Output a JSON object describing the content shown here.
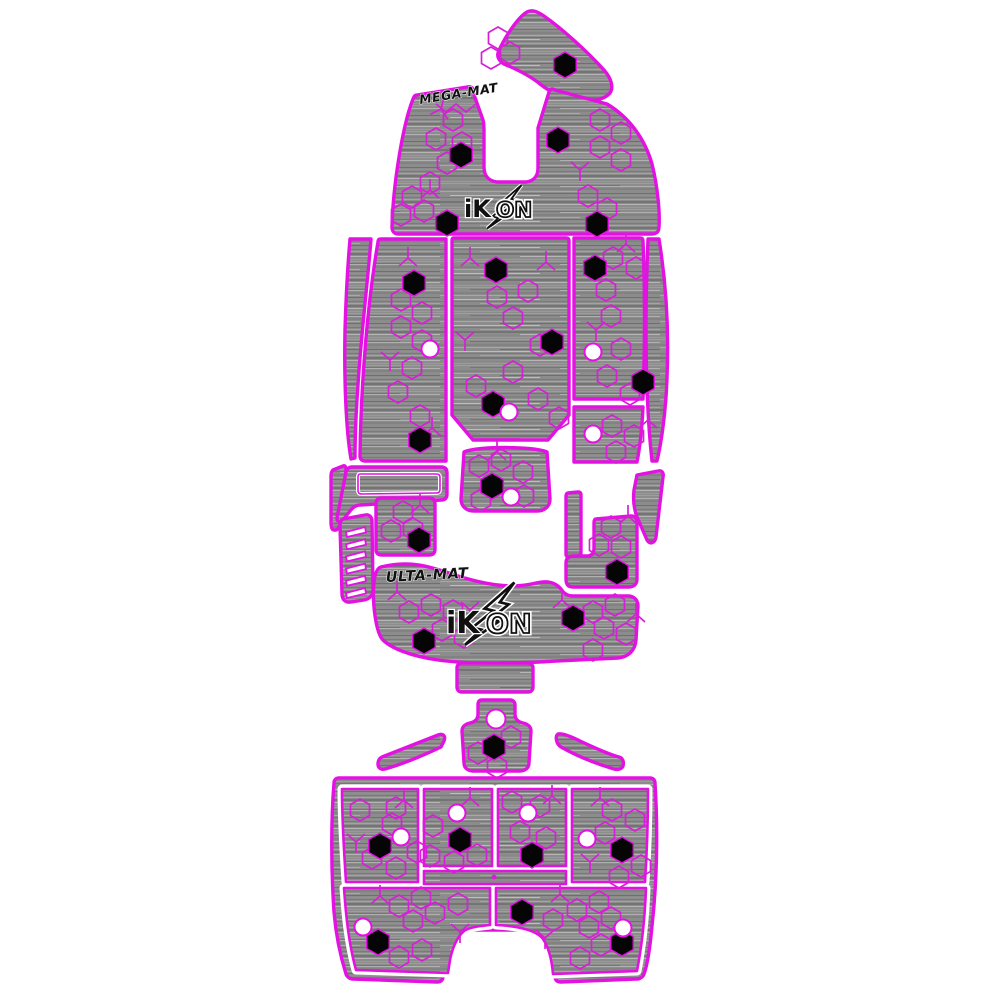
{
  "branding": {
    "mega_mat_label": "MEGA-MAT",
    "ulta_mat_label": "ULTA-MAT",
    "ikon_label": "iKON",
    "ikon_solid": "iK",
    "ikon_hollow": "ON"
  },
  "colors": {
    "outline": "#e312e3",
    "pattern": "#d81fd8",
    "mat-base": "#8c8c8c",
    "cutout-hex": "#050505",
    "cutout-circle": "#ffffff",
    "logo-ink": "#101010",
    "background": "#ffffff"
  }
}
